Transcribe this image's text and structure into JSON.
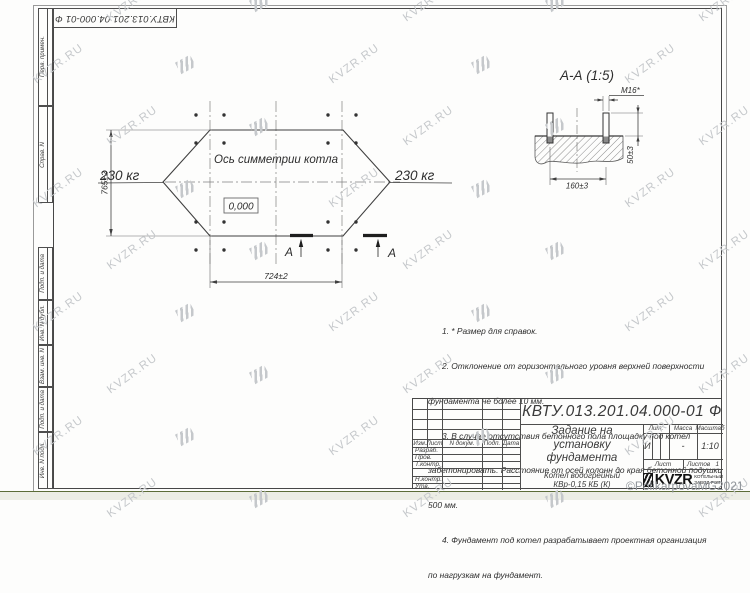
{
  "frame": {
    "designation_top": "КВТУ.013.201.04.000-01 Ф",
    "stamp_labels": [
      "Перв. примен.",
      "Справ. N",
      "Подп. и дата",
      "Инв. N дубл.",
      "Взам. инв. N",
      "Подп. и дата",
      "Инв. N подл."
    ]
  },
  "plan": {
    "axis_label": "Ось симметрии котла",
    "level_mark": "0,000",
    "load_left": "230 кг",
    "load_right": "230 кг",
    "dim_height": "765±2",
    "dim_width": "724±2",
    "section_letter": "А"
  },
  "section": {
    "title": "А-А (1:5)",
    "thread_label": "М16*",
    "dim_width": "160±3",
    "dim_height": "50±3"
  },
  "notes": {
    "lines": [
      "      1. * Размер для справок.",
      "      2. Отклонение от горизонтального уровня верхней поверхности",
      "фундамента не более 10 мм.",
      "      3. В случае отсутствия бетонного пола площадку под котел",
      "забетонировать. Расстояние от осей колонн до края бетонной подушки",
      "500 мм.",
      "      4. Фундамент под котел разрабатывает проектная организация",
      "по нагрузкам на фундамент."
    ]
  },
  "title_block": {
    "designation": "КВТУ.013.201.04.000-01 Ф",
    "doc_title_l1": "Задание на",
    "doc_title_l2": "установку",
    "doc_title_l3": "фундамента",
    "product_l1": "Котел водогрейный",
    "product_l2": "КВр-0,15 КБ (К)",
    "col_izm": "Изм.",
    "col_list": "Лист",
    "col_ndoc": "N докум.",
    "col_podp": "Подп.",
    "col_data": "Дата",
    "row_razrab": "Разраб.",
    "row_prov": "Пров.",
    "row_tkontr": "Т.контр.",
    "row_nkontr": "Н.контр.",
    "row_utv": "Утв.",
    "lit_label": "Лит.",
    "lit_value": "И",
    "massa_label": "Масса",
    "massa_value": "-",
    "masshtab_label": "Масштаб",
    "masshtab_value": "1:10",
    "list_label": "Лист",
    "listov_label": "Листов",
    "listov_value": "1",
    "logo_text": "KVZR",
    "logo_sub1": "КОТЕЛЬНЫЙ",
    "logo_sub2": "ЗАВОД РЭП"
  },
  "watermark": {
    "text": "KVZR.RU",
    "copyright": "©PolikarpovaMG2021"
  },
  "colors": {
    "line": "#4e4e4e",
    "watermark": "#c5c8cb",
    "bottom_strip": "#5c6c38"
  }
}
